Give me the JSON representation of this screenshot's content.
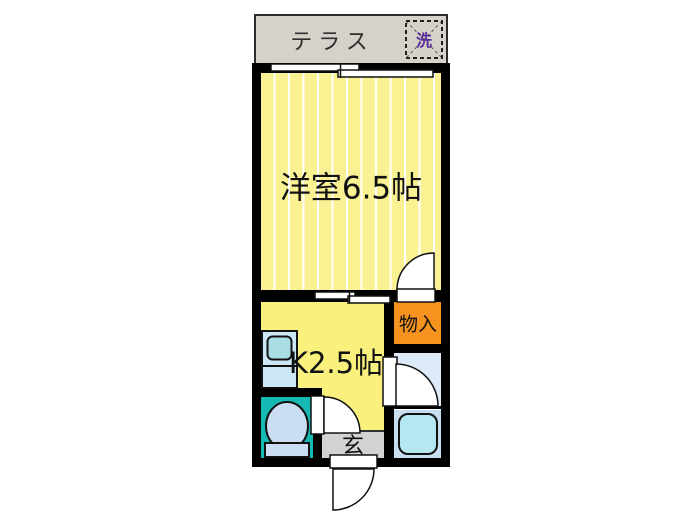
{
  "floorplan": {
    "terrace": {
      "label": "テラス"
    },
    "washer_slot": {
      "label": "洗"
    },
    "main_room": {
      "label": "洋室6.5帖"
    },
    "kitchen": {
      "label": "K2.5帖"
    },
    "closet": {
      "label": "物入"
    },
    "entrance": {
      "label": "玄"
    },
    "colors": {
      "terrace_gray": "#D6D2CA",
      "main_room_yellow": "#FAF192",
      "stripe_white": "#FFFFFF",
      "kitchen_yellow": "#F9F07E",
      "closet_orange": "#F6921E",
      "toilet_teal": "#16B8B4",
      "bathroom_blue": "#DCEBF7",
      "bath_lower_blue": "#C6DFF0",
      "bathtub_cyan": "#B5E7F3",
      "fixture_blue": "#CBE7F6",
      "sink_basin_teal": "#A9DDE4",
      "entrance_gray": "#D2D2D2",
      "wall_black": "#000000",
      "washer_purple": "#5B2D9B"
    }
  }
}
